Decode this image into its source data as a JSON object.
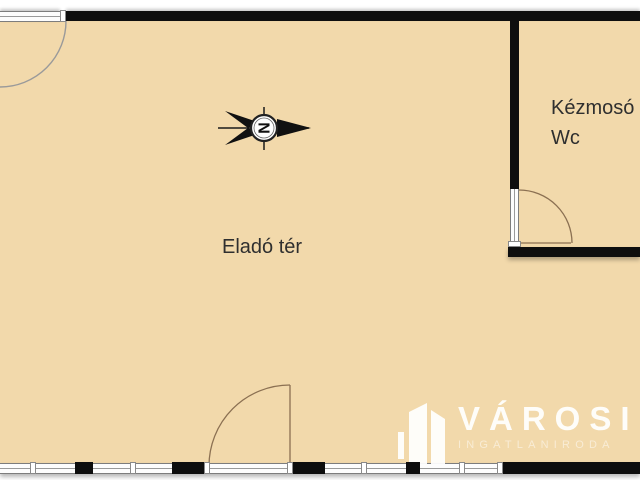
{
  "floorplan": {
    "rooms": {
      "main": {
        "label": "Eladó tér"
      },
      "wc": {
        "label_line1": "Kézmosó",
        "label_line2": "Wc"
      }
    },
    "compass": {
      "letter": "N"
    },
    "colors": {
      "floor": "#f2d9ab",
      "wall": "#0e0e0e",
      "door_arc": "#8b7052",
      "entry_arc_gray": "#9a9a9a",
      "label_text": "#2f2f2f"
    }
  },
  "watermark": {
    "name": "VÁROSI",
    "subtitle": "INGATLANIRODA"
  }
}
